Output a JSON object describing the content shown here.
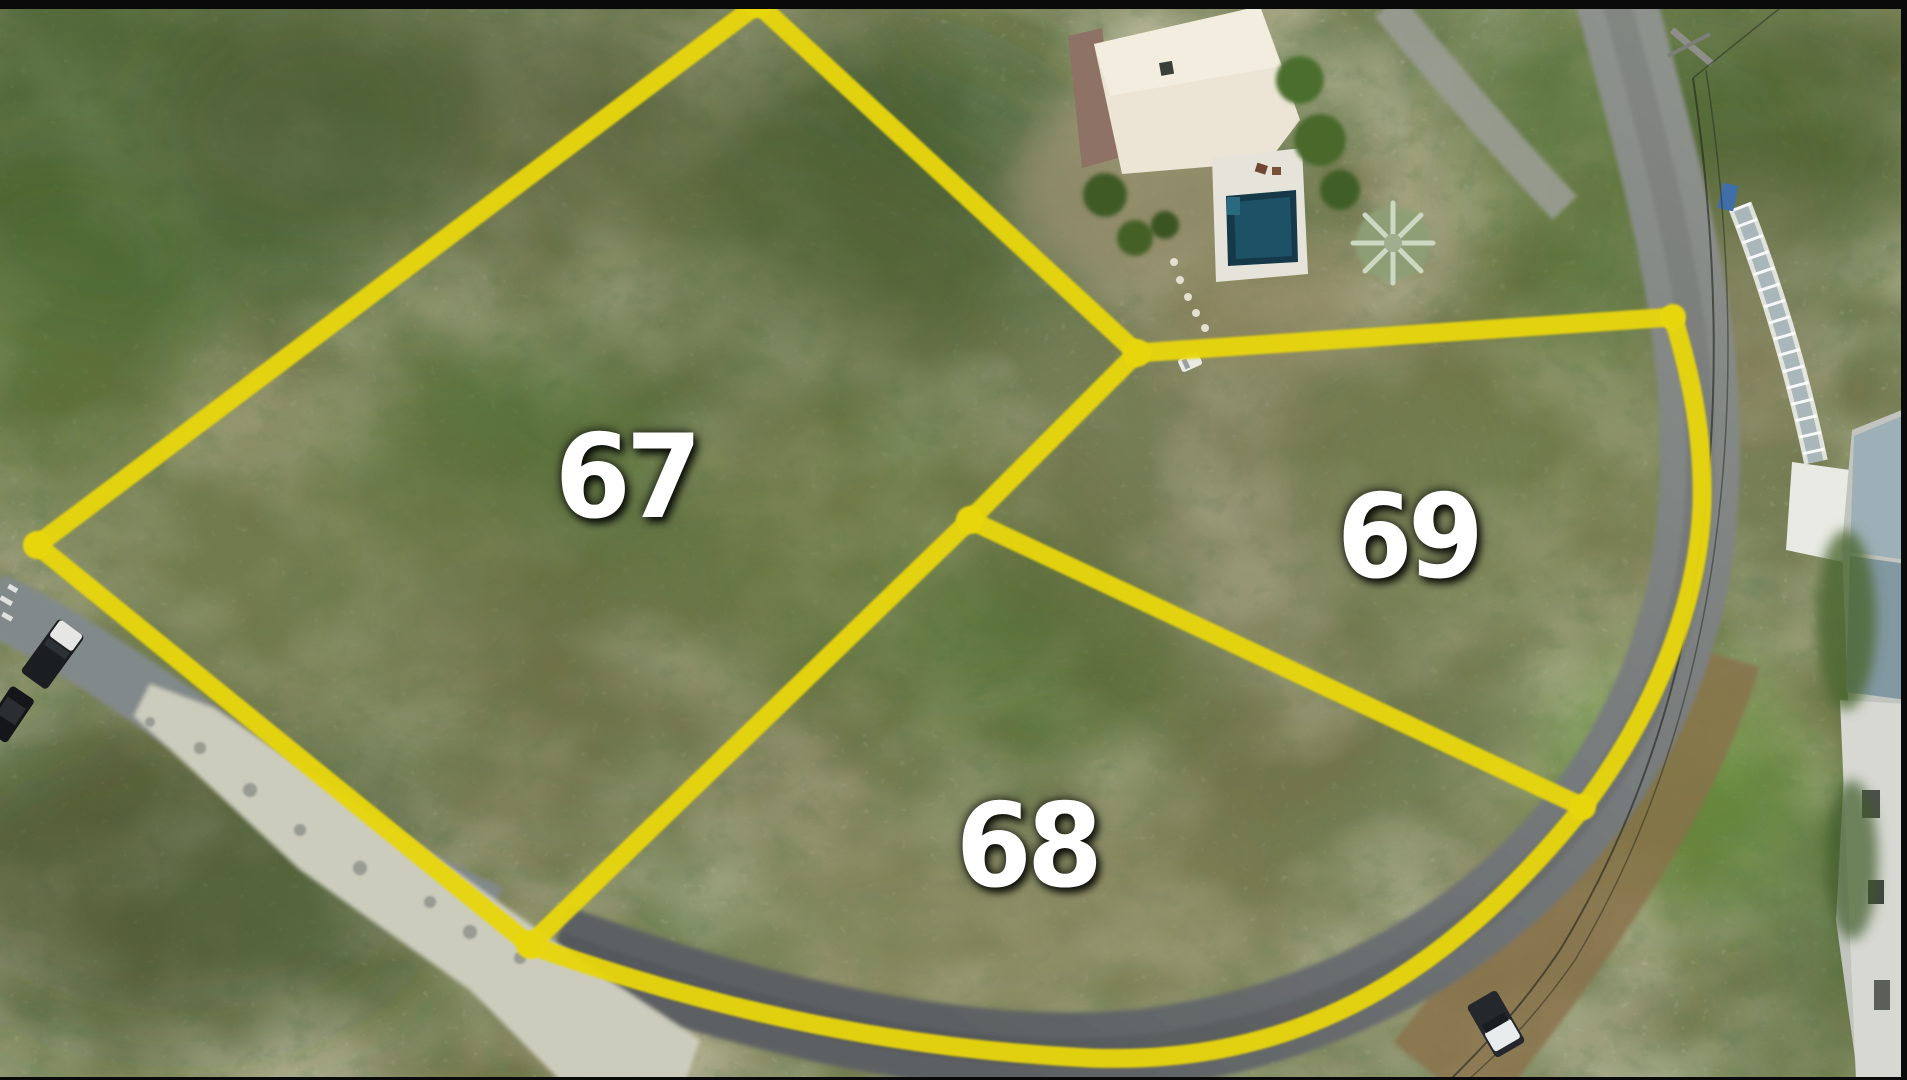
{
  "overlay": {
    "boundary_color": "#e8d60e",
    "label_color": "#ffffff",
    "lots": [
      {
        "number": "67"
      },
      {
        "number": "68"
      },
      {
        "number": "69"
      }
    ]
  }
}
